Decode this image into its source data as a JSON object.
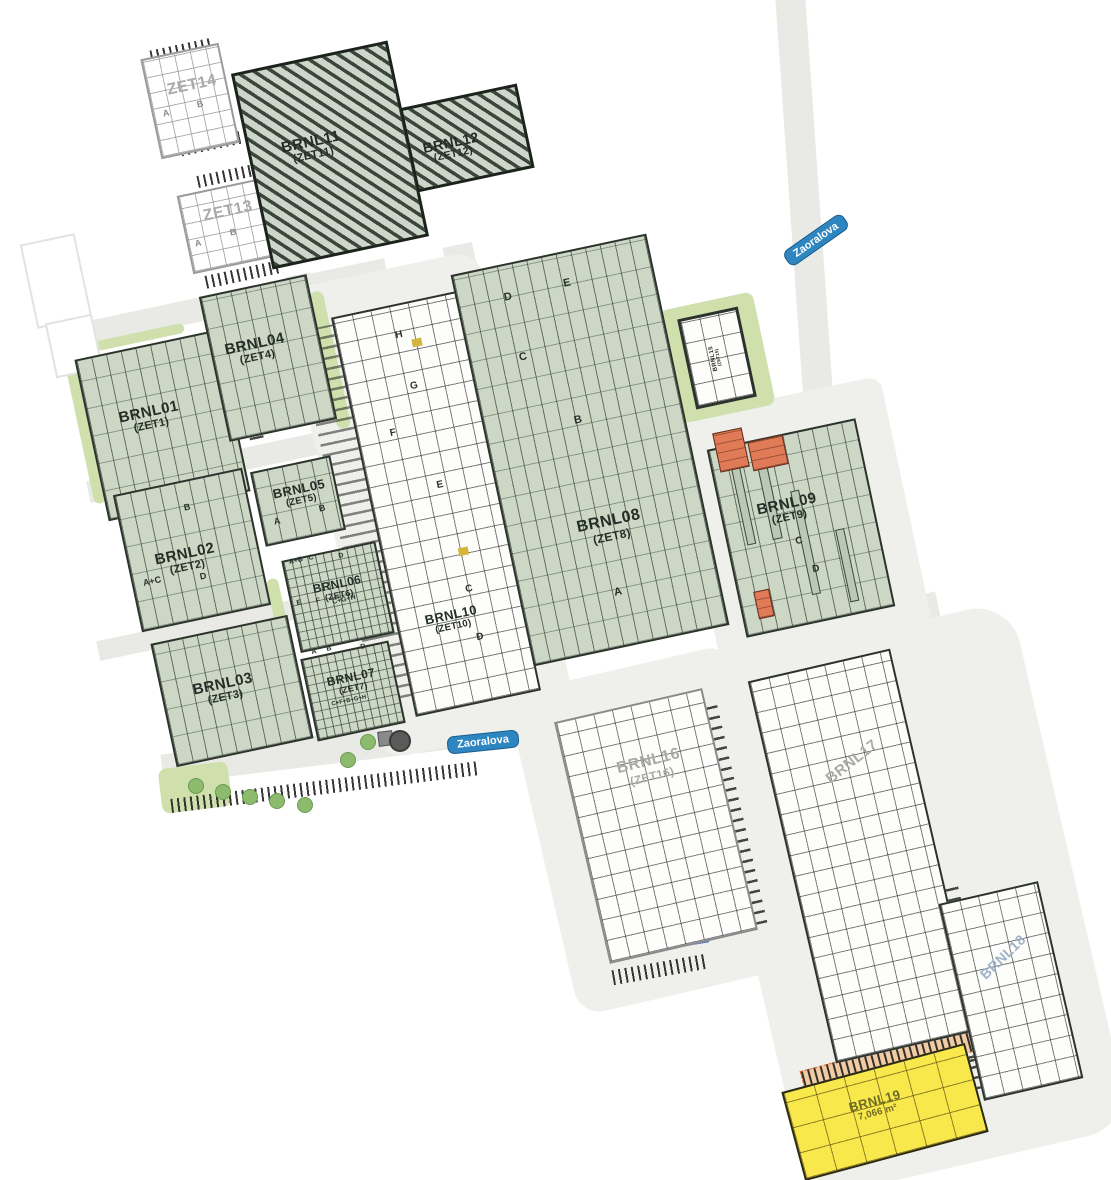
{
  "streets": {
    "zaoralova": "Zaoralova"
  },
  "buildings": {
    "zet14": {
      "label": "ZET14",
      "units": [
        "A",
        "B"
      ]
    },
    "zet13": {
      "label": "ZET13",
      "units": [
        "A",
        "B"
      ]
    },
    "brnl11": {
      "label": "BRNL11",
      "zet": "(ZET11)"
    },
    "brnl12": {
      "label": "BRNL12",
      "zet": "(ZET12)"
    },
    "brnl01": {
      "label": "BRNL01",
      "zet": "(ZET1)"
    },
    "brnl04": {
      "label": "BRNL04",
      "zet": "(ZET4)"
    },
    "brnl02": {
      "label": "BRNL02",
      "zet": "(ZET2)",
      "units": [
        "B",
        "D",
        "A+C"
      ]
    },
    "brnl05": {
      "label": "BRNL05",
      "zet": "(ZET5)",
      "units": [
        "A",
        "B"
      ]
    },
    "brnl06": {
      "label": "BRNL06",
      "zet": "(ZET6)",
      "units": [
        "A+B",
        "C",
        "D",
        "E",
        "F",
        "C+G+H"
      ]
    },
    "brnl07": {
      "label": "BRNL07",
      "zet": "(ZET7)",
      "units": [
        "A",
        "B",
        "D",
        "C+F+B+G+H"
      ]
    },
    "brnl03": {
      "label": "BRNL03",
      "zet": "(ZET3)"
    },
    "brnl10": {
      "label": "BRNL10",
      "zet": "(ZET10)",
      "units": [
        "H",
        "G",
        "F",
        "E",
        "C",
        "D"
      ]
    },
    "brnl08": {
      "label": "BRNL08",
      "zet": "(ZET8)",
      "units": [
        "D",
        "E",
        "C",
        "B",
        "A"
      ]
    },
    "brnl15": {
      "label": "BRNL15",
      "zet": "(ZET15)"
    },
    "brnl09": {
      "label": "BRNL09",
      "zet": "(ZET9)",
      "units": [
        "C",
        "D"
      ]
    },
    "brnl16": {
      "label": "BRNL16",
      "zet": "(ZET16)"
    },
    "brnl17": {
      "label": "BRNL17"
    },
    "brnl18": {
      "label": "BRNL18"
    },
    "brnl19": {
      "label": "BRNL19",
      "area": "7,066 m²"
    }
  },
  "colors": {
    "street_badge_blue": "#2e86c1",
    "building_green": "#ccd7c5",
    "hatch_dark_green": "#3a463d",
    "highlight_yellow": "#f9e84b",
    "accent_orange": "#e07a57",
    "dock_blue": "#3a57c4"
  }
}
